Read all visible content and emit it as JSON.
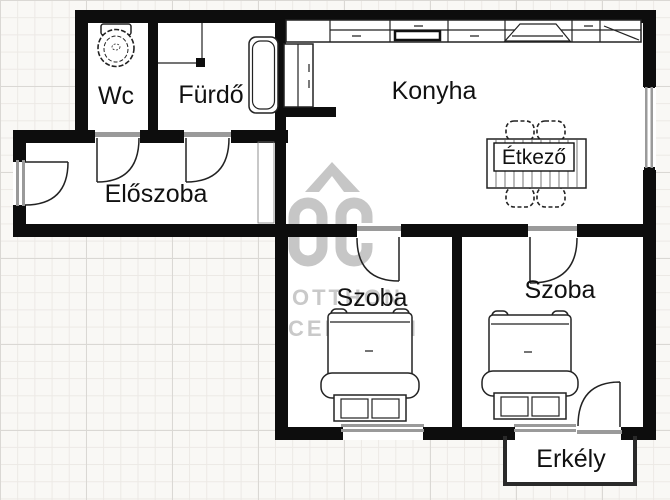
{
  "rooms": {
    "wc": {
      "label": "Wc"
    },
    "bathroom": {
      "label": "Fürdő"
    },
    "kitchen": {
      "label": "Konyha"
    },
    "dining": {
      "label": "Étkező"
    },
    "hallway": {
      "label": "Előszoba"
    },
    "room1": {
      "label": "Szoba"
    },
    "room2": {
      "label": "Szoba"
    },
    "balcony": {
      "label": "Erkély"
    }
  },
  "watermark": {
    "logo": "OC",
    "line1": "OTTHON",
    "line2": "CENTRUM"
  },
  "colors": {
    "wall": "#0d0d0d",
    "door_window_opening": "#9a9a9a",
    "watermark_gray": "#c6c6c6",
    "paper": "#f9f8f5",
    "grid_minor": "#ece9e5",
    "grid_major": "#dad8d4"
  }
}
